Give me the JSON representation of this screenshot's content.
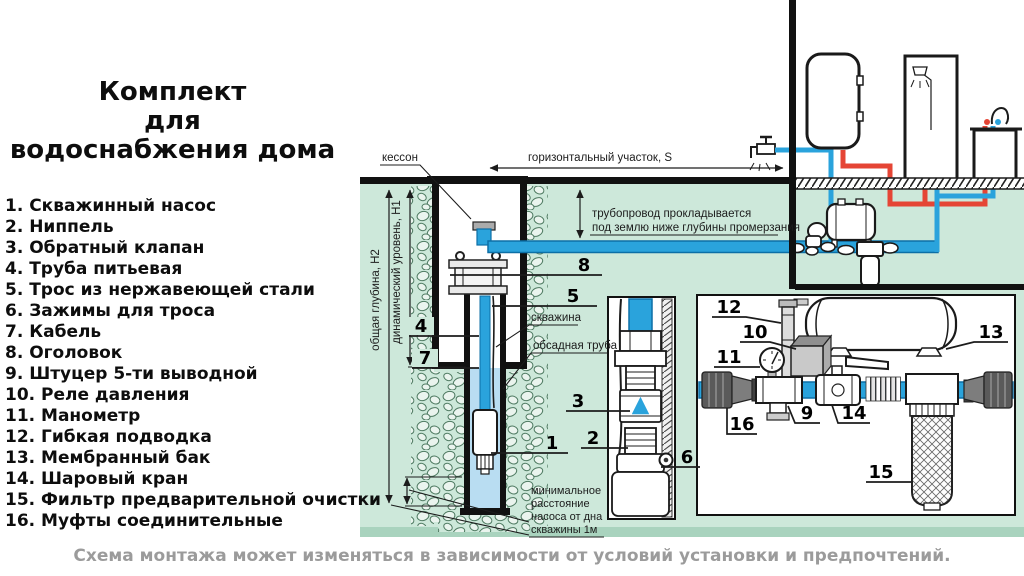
{
  "title": {
    "line1": "Комплект",
    "line2": "для",
    "line3": "водоснабжения дома"
  },
  "legend": {
    "items": [
      "1. Скважинный насос",
      "2. Ниппель",
      "3. Обратный клапан",
      "4. Труба питьевая",
      "5. Трос из нержавеющей стали",
      "6. Зажимы для троса",
      "7. Кабель",
      "8. Оголовок",
      "9. Штуцер 5-ти выводной",
      "10. Реле давления",
      "11. Манометр",
      "12. Гибкая подводка",
      "13. Мембранный бак",
      "14. Шаровый кран",
      "15. Фильтр предварительной очистки",
      "16. Муфты соединительные"
    ]
  },
  "diagram": {
    "labels": {
      "kesson": "кессон",
      "horizontal_section": "горизонтальный участок, S",
      "pipe_note1": "трубопровод прокладывается",
      "pipe_note2": "под землю ниже глубины промерзания",
      "total_depth": "общая глубина, H2",
      "dynamic_level": "динамический уровень, H1",
      "well": "скважина",
      "casing": "обсадная труба",
      "min1": "минимальное",
      "min2": "расстояние",
      "min3": "насоса от дна",
      "min4": "скважины 1м"
    },
    "callouts": {
      "n1": "1",
      "n2": "2",
      "n3": "3",
      "n4": "4",
      "n5": "5",
      "n6": "6",
      "n7": "7",
      "n8": "8",
      "n9": "9",
      "n10": "10",
      "n11": "11",
      "n12": "12",
      "n13": "13",
      "n14": "14",
      "n15": "15",
      "n16": "16"
    }
  },
  "caption": "Схема монтажа может изменяться в зависимости от условий установки и предпочтений.",
  "colors": {
    "ground": "#cde8da",
    "ground_edge": "#a9d3be",
    "pipe_blue": "#2aa3dc",
    "pipe_blue_dark": "#0c6fa6",
    "pipe_red": "#e54535",
    "water": "#b9ddf2",
    "line": "#1a1a1a",
    "caption_gray": "#9b9b9b"
  }
}
